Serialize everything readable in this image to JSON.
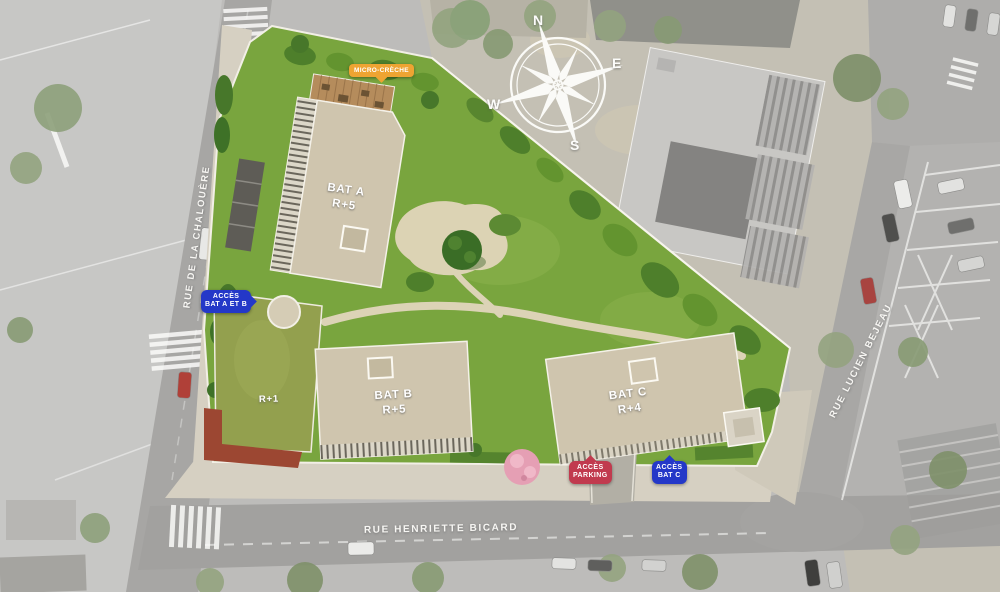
{
  "plan": {
    "streets": {
      "chalouere": "RUE DE LA CHALOUÈRE",
      "bejeau": "RUE LUCIEN BEJEAU",
      "bicard": "RUE HENRIETTE BICARD"
    },
    "buildings": {
      "bat_a": {
        "name": "BAT A",
        "level": "R+5"
      },
      "bat_b": {
        "name": "BAT B",
        "level": "R+5"
      },
      "bat_c": {
        "name": "BAT C",
        "level": "R+4"
      },
      "annex": {
        "level": "R+1"
      }
    },
    "badges": {
      "access_ab": {
        "line1": "ACCÈS",
        "line2": "BAT A ET B",
        "color": "#2438c8"
      },
      "access_parking": {
        "line1": "ACCÈS",
        "line2": "PARKING",
        "color": "#c13a4e"
      },
      "access_c": {
        "line1": "ACCÈS",
        "line2": "BAT C",
        "color": "#2438c8"
      },
      "creche": {
        "label": "MICRO-CRÈCHE",
        "color": "#eea432"
      }
    },
    "compass": {
      "n": "N",
      "e": "E",
      "s": "S",
      "w": "W"
    },
    "colors": {
      "lawn": "#79a53e",
      "roof": "#cfc5ae",
      "green_roof": "#93a04e",
      "terrace": "#9c4732",
      "path": "#dcd3b6",
      "pink_tree": "#e59fb4",
      "background": "#bdbcba"
    }
  }
}
